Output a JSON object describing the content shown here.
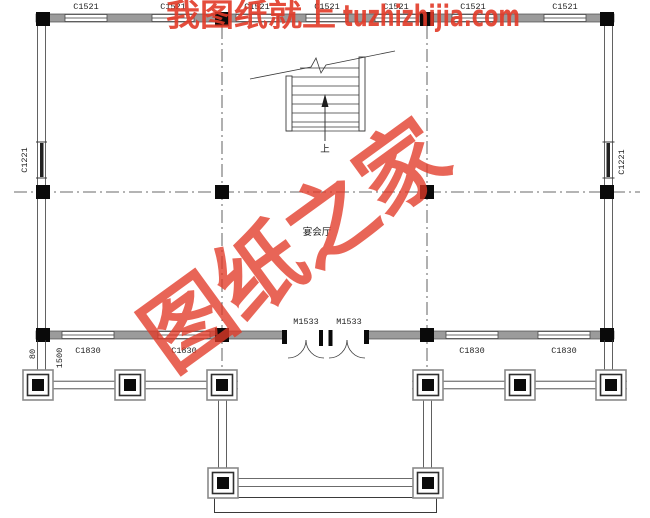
{
  "watermark": {
    "top_text_cn": "我图纸就上",
    "top_text_domain": "tuzhizhijia.com",
    "diagonal_text": "图纸之家"
  },
  "labels": {
    "window_top": "C1521",
    "window_bottom": "C1830",
    "window_side": "C1221",
    "door": "M1533",
    "room": "宴会厅",
    "stair_up": "上",
    "dim_small": "80",
    "dim_porch": "1500"
  },
  "colors": {
    "watermark_red": "#e23a28",
    "line": "#3a3a3a",
    "wall_gray": "#9b9b9b",
    "column_black": "#0a0a0a"
  }
}
